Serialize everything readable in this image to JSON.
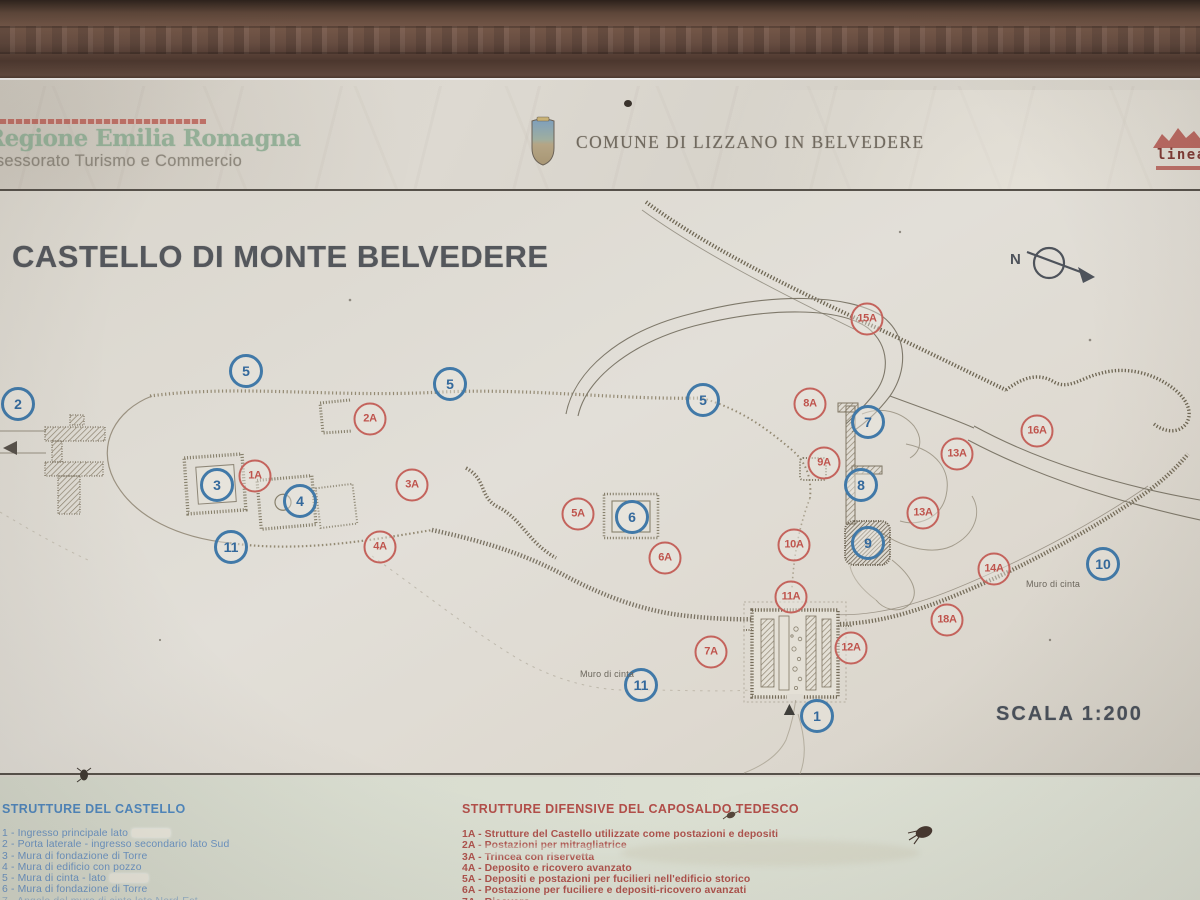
{
  "header": {
    "region_line1": "Regione Emilia Romagna",
    "region_line2": "Assessorato Turismo e Commercio",
    "comune_label": "COMUNE DI LIZZANO IN BELVEDERE",
    "linea_label": "linea"
  },
  "map": {
    "title": "CASTELLO DI MONTE BELVEDERE",
    "compass_label": "N",
    "scale_label": "SCALA 1:200",
    "start_symbol": "▲",
    "wall_labels": [
      "Muro di cinta",
      "Muro di cinta"
    ]
  },
  "markers": {
    "blue": [
      {
        "label": "1",
        "x": 817,
        "y": 716
      },
      {
        "label": "2",
        "x": 18,
        "y": 404
      },
      {
        "label": "3",
        "x": 217,
        "y": 485
      },
      {
        "label": "4",
        "x": 300,
        "y": 501
      },
      {
        "label": "5",
        "x": 246,
        "y": 371
      },
      {
        "label": "5",
        "x": 450,
        "y": 384
      },
      {
        "label": "5",
        "x": 703,
        "y": 400
      },
      {
        "label": "6",
        "x": 632,
        "y": 517
      },
      {
        "label": "7",
        "x": 868,
        "y": 422
      },
      {
        "label": "8",
        "x": 861,
        "y": 485
      },
      {
        "label": "9",
        "x": 868,
        "y": 543
      },
      {
        "label": "10",
        "x": 1103,
        "y": 564
      },
      {
        "label": "11",
        "x": 231,
        "y": 547
      },
      {
        "label": "11",
        "x": 641,
        "y": 685
      }
    ],
    "red": [
      {
        "label": "1A",
        "x": 255,
        "y": 476
      },
      {
        "label": "2A",
        "x": 370,
        "y": 419
      },
      {
        "label": "3A",
        "x": 412,
        "y": 485
      },
      {
        "label": "4A",
        "x": 380,
        "y": 547
      },
      {
        "label": "5A",
        "x": 578,
        "y": 514
      },
      {
        "label": "6A",
        "x": 665,
        "y": 558
      },
      {
        "label": "7A",
        "x": 711,
        "y": 652
      },
      {
        "label": "8A",
        "x": 810,
        "y": 404
      },
      {
        "label": "9A",
        "x": 824,
        "y": 463
      },
      {
        "label": "10A",
        "x": 794,
        "y": 545
      },
      {
        "label": "11A",
        "x": 791,
        "y": 597
      },
      {
        "label": "12A",
        "x": 851,
        "y": 648
      },
      {
        "label": "13A",
        "x": 957,
        "y": 454
      },
      {
        "label": "13A",
        "x": 923,
        "y": 513
      },
      {
        "label": "14A",
        "x": 994,
        "y": 569
      },
      {
        "label": "15A",
        "x": 867,
        "y": 319
      },
      {
        "label": "16A",
        "x": 1037,
        "y": 431
      },
      {
        "label": "18A",
        "x": 947,
        "y": 620
      }
    ]
  },
  "legend_left": {
    "title": "STRUTTURE DEL CASTELLO",
    "items": [
      {
        "num": "1",
        "text": "Ingresso principale lato",
        "patched": true
      },
      {
        "num": "2",
        "text": "Porta laterale - ingresso secondario lato Sud"
      },
      {
        "num": "3",
        "text": "Mura di fondazione di Torre"
      },
      {
        "num": "4",
        "text": "Mura di edificio con pozzo"
      },
      {
        "num": "5",
        "text": "Mura di cinta - lato",
        "patched": true
      },
      {
        "num": "6",
        "text": "Mura di fondazione di Torre"
      },
      {
        "num": "7",
        "text": "Angolo del muro di cinta lato Nord-Est"
      }
    ]
  },
  "legend_right": {
    "title": "STRUTTURE DIFENSIVE DEL CAPOSALDO TEDESCO",
    "items": [
      {
        "num": "1A",
        "text": "Strutture del Castello utilizzate come postazioni e depositi"
      },
      {
        "num": "2A",
        "text": "Postazioni per mitragliatrice"
      },
      {
        "num": "3A",
        "text": "Trincea con riservetta"
      },
      {
        "num": "4A",
        "text": "Deposito e ricovero avanzato"
      },
      {
        "num": "5A",
        "text": "Depositi e postazioni per fucilieri nell'edificio storico"
      },
      {
        "num": "6A",
        "text": "Postazione per fuciliere e depositi-ricovero avanzati"
      },
      {
        "num": "7A",
        "text": "Ricovero"
      },
      {
        "num": "8A",
        "text": "Postazione per fuciliere"
      }
    ]
  },
  "colors": {
    "blue_marker": "#4179a8",
    "red_marker": "#c4635c",
    "legend_blue": "#5b8fc4",
    "legend_red": "#b2524c",
    "title_gray": "#54575c",
    "frame_brown": "#5d4639",
    "region_green": "#94af97",
    "linea_red": "#b2544c"
  }
}
